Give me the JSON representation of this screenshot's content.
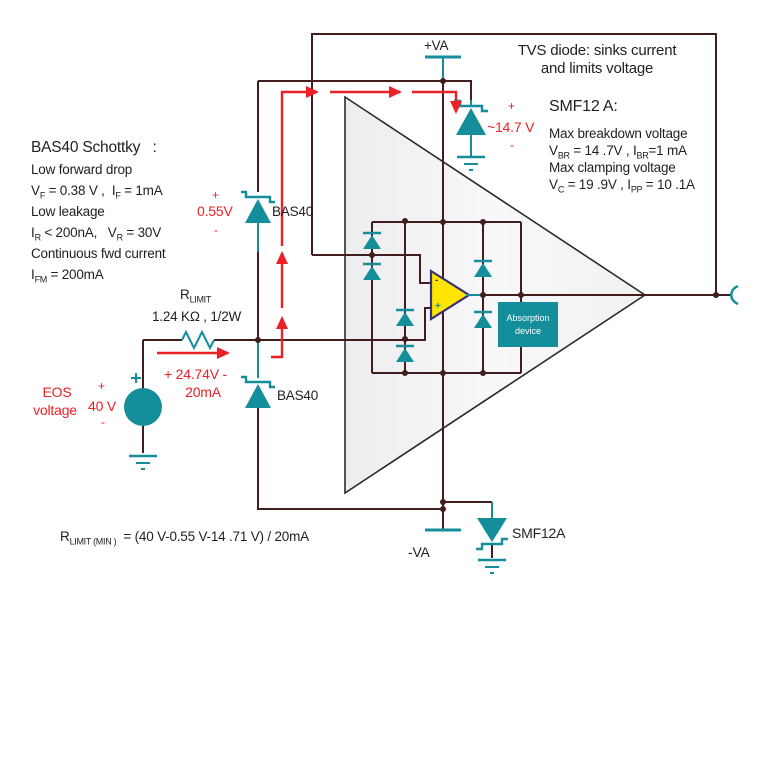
{
  "left_block": {
    "title": "BAS40 Schottky   :",
    "l1": "Low forward drop",
    "l2": [
      "V",
      "_F",
      " = 0.38 V ,  I",
      "_F",
      " = 1mA"
    ],
    "l3": "Low leakage",
    "l4": [
      "I",
      "_R",
      " < 200nA,   V",
      "_R",
      " = 30V"
    ],
    "l5": "Continuous fwd current",
    "l6": [
      "I",
      "_FM",
      " = 200mA"
    ]
  },
  "tvs_note": {
    "l1": "TVS diode: sinks current",
    "l2": "and limits voltage"
  },
  "smf_block": {
    "title": "SMF12 A:",
    "l1": "Max breakdown voltage",
    "l2": [
      "V",
      "_BR",
      " = 14 .7V , I",
      "_BR",
      "=1 mA"
    ],
    "l3": "Max clamping voltage",
    "l4": [
      "V",
      "_C",
      " = 19 .9V , I",
      "_PP",
      " = 10 .1A"
    ]
  },
  "supplies": {
    "positive": "+VA",
    "negative": "-VA"
  },
  "components": {
    "bas40_upper": "BAS40",
    "bas40_lower": "BAS40",
    "smf12a": "SMF12A",
    "resistor_name": [
      "R",
      "_LIMIT"
    ],
    "resistor_value": "1.24 KΩ , 1/2W",
    "absorption_l1": "Absorption",
    "absorption_l2": "device",
    "opamp_minus": "-",
    "opamp_plus": "+"
  },
  "red_annotations": {
    "eos_l1": "EOS",
    "eos_l2": "voltage",
    "src_plus": "+",
    "src_value": "40 V",
    "src_minus": "-",
    "drop_resistor": "+ 24.74V -",
    "current": "20mA",
    "bas40_plus": "+",
    "bas40_drop": "0.55V",
    "bas40_minus": "-",
    "tvs_plus": "+",
    "tvs_clamp": "~14.7 V",
    "tvs_minus": "-"
  },
  "formula": [
    "R",
    "_LIMIT (MIN )",
    "  = (40 V-0.55 V-14 .71 V) / 20mA"
  ],
  "colors": {
    "teal": "#148e9b",
    "red": "#ec2027",
    "wire": "#421d1e",
    "yellow": "#ffe500",
    "opamp_border": "#39307a",
    "triangle_fill": "#f3f3f5",
    "text": "#221e1f"
  }
}
